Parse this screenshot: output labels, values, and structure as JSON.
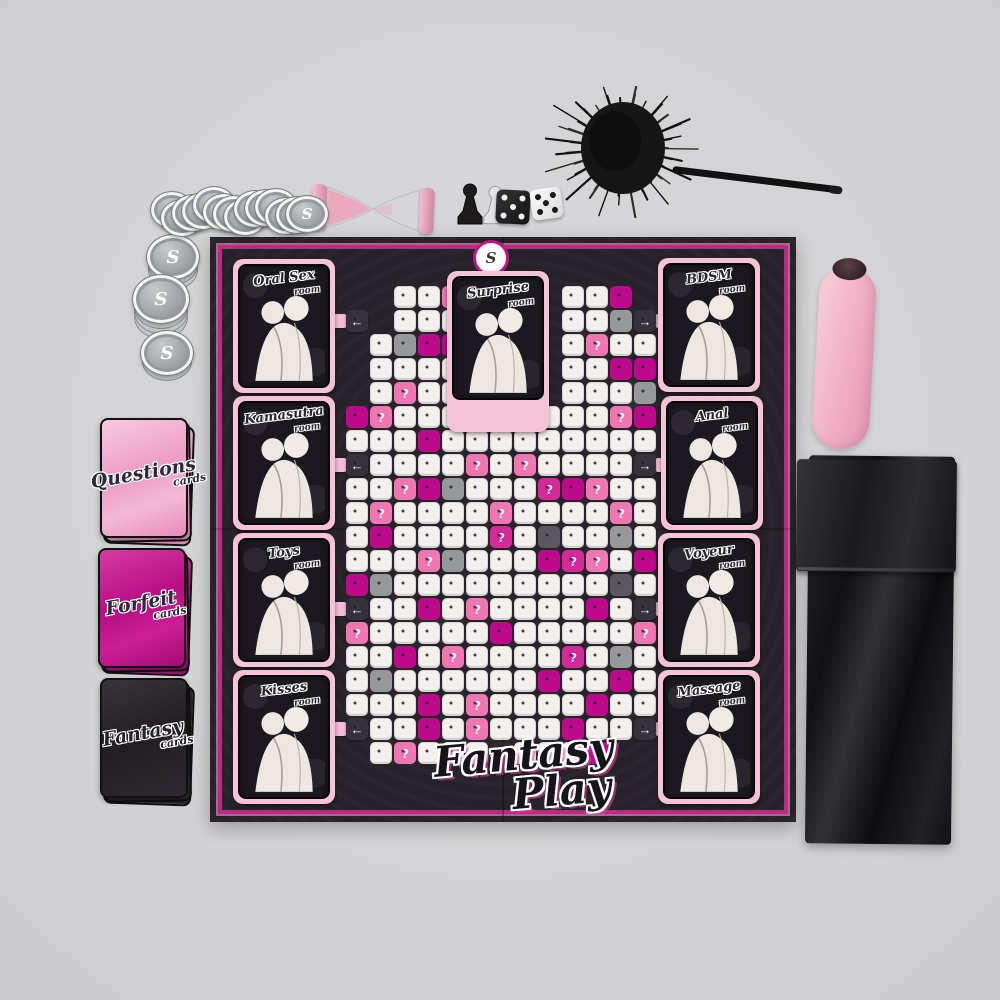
{
  "scene": {
    "background": "#d2d2d4",
    "description": "Fantasy Play adult board game flat-lay with components"
  },
  "board": {
    "title_line1": "Fantasy",
    "title_line2": "Play",
    "start_label": "Start",
    "logo_letter": "S",
    "colors": {
      "board_bg": "#272229",
      "border_magenta": "#d81b8a",
      "frame_pink": "#f4c3d8",
      "cell_white": "#f2efec",
      "cell_pink": "#ef76b3",
      "cell_magenta": "#bd0a8b",
      "cell_gray": "#97989a",
      "tile_dark": "#36313a"
    },
    "rooms": [
      {
        "id": "oral-sex",
        "title": "Oral Sex",
        "subtitle": "room"
      },
      {
        "id": "surprise",
        "title": "Surprise",
        "subtitle": "room"
      },
      {
        "id": "bdsm",
        "title": "BDSM",
        "subtitle": "room"
      },
      {
        "id": "kamasutra",
        "title": "Kamasutra",
        "subtitle": "room"
      },
      {
        "id": "anal",
        "title": "Anal",
        "subtitle": "room"
      },
      {
        "id": "toys",
        "title": "Toys",
        "subtitle": "room"
      },
      {
        "id": "voyeur",
        "title": "Voyeur",
        "subtitle": "room"
      },
      {
        "id": "kisses",
        "title": "Kisses",
        "subtitle": "room"
      },
      {
        "id": "massage",
        "title": "Massage",
        "subtitle": "room"
      }
    ],
    "grid": {
      "cols": 13,
      "rows": 20,
      "cell_px": 24,
      "legend": {
        "w": "white",
        "p": "pink-question",
        "q": "magenta-question",
        "m": "magenta",
        "g": "gray",
        "d": "dark-gray",
        "L": "arrow-left",
        "R": "arrow-right",
        "U": "arrow-up",
        "S": "start",
        ".": "empty"
      },
      "glyphs": {
        "question": "?",
        "left": "←",
        "right": "→",
        "up": "↑"
      },
      "rows_encoded": [
        "..wwp....wwm.",
        "L.www....wwgR",
        ".wgmm....wpww",
        ".wwww....wwmm",
        ".wpww....wwwg",
        "mpwwwwUwwwwpm",
        "wwwmwwwwwwwww",
        "LwwwwpwpwwwwR",
        "wwpmgwwwqmpww",
        "wpwwwwpwwwwpw",
        "wmwwwwqwdwwgw",
        "wwwpgwwwmqpwm",
        "mgwwwwwwwwwdw",
        "LwwmwpwwwwmwR",
        "pwwwwwmwwwwwp",
        "wwmwpwwwwqwgw",
        "wgwwwwwwmwwmw",
        "wwwmwpwwwwmww",
        "LwwmwpwwwmwwR",
        ".wpwwwSwwwm.."
      ]
    }
  },
  "decks": [
    {
      "id": "questions",
      "title": "Questions",
      "subtitle": "cards",
      "color": "#ee9cc5"
    },
    {
      "id": "forfeit",
      "title": "Forfeit",
      "subtitle": "cards",
      "color": "#b70e84"
    },
    {
      "id": "fantasy",
      "title": "Fantasy",
      "subtitle": "cards",
      "color": "#27222a"
    }
  ],
  "tokens": {
    "coin_letter": "S",
    "loose_count": 14,
    "stacks": [
      2,
      3,
      1
    ]
  },
  "pieces": {
    "pawns": [
      {
        "color": "black"
      },
      {
        "color": "white"
      }
    ],
    "dice": [
      {
        "color": "black",
        "pips": 5
      },
      {
        "color": "white",
        "pips": 5
      }
    ]
  },
  "accessories": [
    {
      "id": "sand-timer",
      "color": "pink"
    },
    {
      "id": "feather-tickler",
      "color": "black"
    },
    {
      "id": "vibrator",
      "color": "pink"
    },
    {
      "id": "satin-blindfold",
      "color": "black"
    }
  ]
}
